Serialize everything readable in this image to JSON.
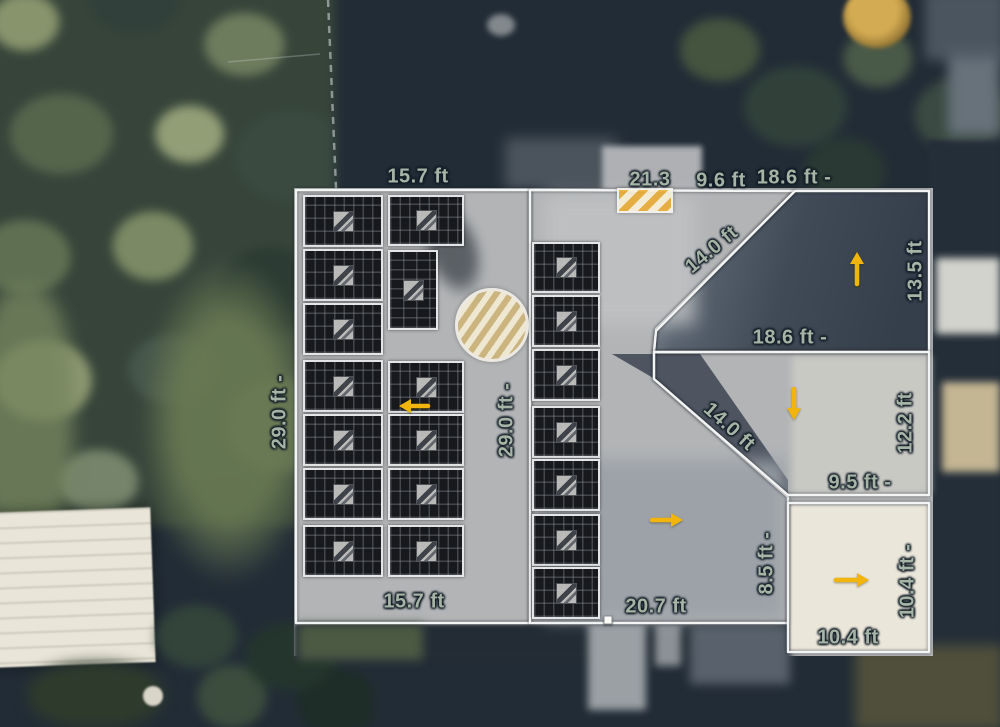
{
  "app": {
    "view": "solar-roof-design-canvas",
    "units": "ft"
  },
  "colors": {
    "outline": "#f3f4f4",
    "arrow": "#f1b50e",
    "label": "#a6b4a6",
    "panel": "#17191d",
    "obstruction_hatch": "#ecac30"
  },
  "measurements": [
    {
      "text": "15.7 ft",
      "x": 418,
      "y": 177,
      "r": 0
    },
    {
      "text": "21.3",
      "x": 650,
      "y": 180,
      "r": 0
    },
    {
      "text": "9.6 ft",
      "x": 721,
      "y": 181,
      "r": 0
    },
    {
      "text": "18.6 ft -",
      "x": 794,
      "y": 178,
      "r": 0
    },
    {
      "text": "14.0 ft",
      "x": 712,
      "y": 250,
      "r": -40
    },
    {
      "text": "13.5 ft",
      "x": 916,
      "y": 271,
      "r": -90
    },
    {
      "text": "18.6 ft -",
      "x": 790,
      "y": 338,
      "r": 0
    },
    {
      "text": "29.0 ft -",
      "x": 280,
      "y": 412,
      "r": -90
    },
    {
      "text": "29.0 ft -",
      "x": 507,
      "y": 420,
      "r": -90
    },
    {
      "text": "14.0 ft",
      "x": 729,
      "y": 427,
      "r": 42
    },
    {
      "text": "12.2 ft",
      "x": 906,
      "y": 423,
      "r": -90
    },
    {
      "text": "9.5 ft -",
      "x": 860,
      "y": 483,
      "r": 0
    },
    {
      "text": "8.5 ft -",
      "x": 767,
      "y": 563,
      "r": -90
    },
    {
      "text": "20.7 ft",
      "x": 656,
      "y": 607,
      "r": 0
    },
    {
      "text": "10.4 ft -",
      "x": 908,
      "y": 581,
      "r": -90
    },
    {
      "text": "10.4 ft",
      "x": 848,
      "y": 638,
      "r": 0
    },
    {
      "text": "15.7 ft",
      "x": 414,
      "y": 602,
      "r": 0
    }
  ],
  "roof_sections": [
    {
      "name": "left",
      "points": "296,190 530,190 530,623 296,623"
    },
    {
      "name": "center",
      "points": "530,190 795,191 656,329 654,352 654,379 788,497 788,623 530,623"
    },
    {
      "name": "top-right",
      "points": "795,191 929,191 929,352 654,352 656,331"
    },
    {
      "name": "middle-right",
      "points": "654,352 929,352 929,495 788,495 654,379"
    },
    {
      "name": "bottom-right",
      "points": "788,503 929,503 929,652 788,652"
    }
  ],
  "panels": [
    {
      "x": 303,
      "y": 195,
      "w": 80,
      "h": 52,
      "o": "l"
    },
    {
      "x": 303,
      "y": 249,
      "w": 80,
      "h": 52,
      "o": "l"
    },
    {
      "x": 303,
      "y": 303,
      "w": 80,
      "h": 52,
      "o": "l"
    },
    {
      "x": 303,
      "y": 360,
      "w": 80,
      "h": 52,
      "o": "l"
    },
    {
      "x": 303,
      "y": 414,
      "w": 80,
      "h": 52,
      "o": "l"
    },
    {
      "x": 303,
      "y": 468,
      "w": 80,
      "h": 52,
      "o": "l"
    },
    {
      "x": 303,
      "y": 525,
      "w": 80,
      "h": 52,
      "o": "l"
    },
    {
      "x": 388,
      "y": 195,
      "w": 76,
      "h": 51,
      "o": "l"
    },
    {
      "x": 388,
      "y": 250,
      "w": 50,
      "h": 80,
      "o": "p"
    },
    {
      "x": 388,
      "y": 361,
      "w": 76,
      "h": 52,
      "o": "l"
    },
    {
      "x": 388,
      "y": 414,
      "w": 76,
      "h": 52,
      "o": "l"
    },
    {
      "x": 388,
      "y": 468,
      "w": 76,
      "h": 52,
      "o": "l"
    },
    {
      "x": 388,
      "y": 525,
      "w": 76,
      "h": 52,
      "o": "l"
    },
    {
      "x": 532,
      "y": 242,
      "w": 68,
      "h": 51,
      "o": "l"
    },
    {
      "x": 532,
      "y": 295,
      "w": 68,
      "h": 52,
      "o": "l"
    },
    {
      "x": 532,
      "y": 349,
      "w": 68,
      "h": 52,
      "o": "l"
    },
    {
      "x": 532,
      "y": 406,
      "w": 68,
      "h": 52,
      "o": "l"
    },
    {
      "x": 532,
      "y": 459,
      "w": 68,
      "h": 52,
      "o": "l"
    },
    {
      "x": 532,
      "y": 514,
      "w": 68,
      "h": 52,
      "o": "l"
    },
    {
      "x": 532,
      "y": 567,
      "w": 68,
      "h": 52,
      "o": "l"
    }
  ],
  "arrows": [
    {
      "dir": "left",
      "x1": 428,
      "y1": 406,
      "x2": 399,
      "y2": 406
    },
    {
      "dir": "up",
      "x1": 857,
      "y1": 284,
      "x2": 857,
      "y2": 252
    },
    {
      "dir": "down",
      "x1": 794,
      "y1": 389,
      "x2": 794,
      "y2": 420
    },
    {
      "dir": "right",
      "x1": 652,
      "y1": 520,
      "x2": 683,
      "y2": 520
    },
    {
      "dir": "right",
      "x1": 836,
      "y1": 580,
      "x2": 869,
      "y2": 580
    }
  ],
  "obstructions": {
    "circle": {
      "x": 455,
      "y": 288,
      "w": 74,
      "h": 74
    },
    "rect": {
      "x": 617,
      "y": 188,
      "w": 56,
      "h": 25
    }
  },
  "vertex": {
    "x": 608,
    "y": 620
  }
}
